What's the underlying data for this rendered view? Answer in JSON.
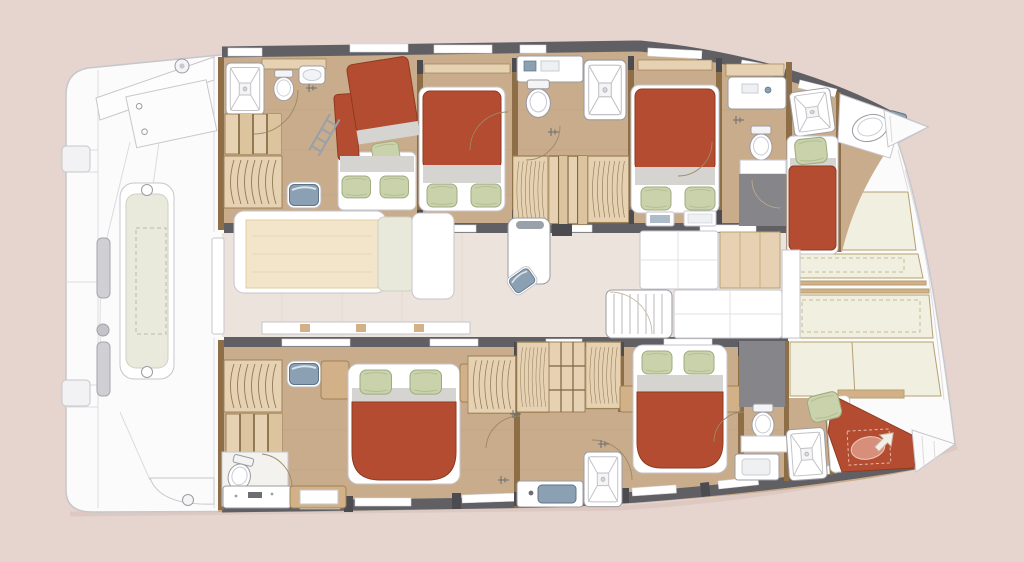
{
  "meta": {
    "title": "Catamaran yacht interior floor plan",
    "view": "top-down deck plan, bow pointing right",
    "diagram_type": "boat-layout"
  },
  "palette": {
    "bg": "#e6d4ce",
    "hull": "#fbfbfc",
    "hullline": "#c7c7cb",
    "seam": "#dcdce0",
    "band": "#5f5f64",
    "banddk": "#4b4b50",
    "wall": "#8d6e46",
    "wood": "#c9ac8b",
    "wooddk": "#b5976f",
    "woodlt": "#e6d2b3",
    "woodmd": "#d3b188",
    "red": "#b44c31",
    "reddk": "#8f3a22",
    "sheet": "#d5d4d1",
    "pillow": "#c9d2ab",
    "pillowdk": "#9fac7f",
    "fixline": "#9b9ba1",
    "fixlinelt": "#c6c6cc",
    "steel": "#8ba0b2",
    "steeldk": "#5f7386",
    "salon": "#ece3dd",
    "salonline": "#ddd0c7",
    "table": "#f3e5ca",
    "tabledk": "#e2cda4",
    "cream": "#f0efe0",
    "creamline": "#b4a071",
    "grayfloor": "#85858a",
    "bench": "#e9eadb",
    "shadow": "#d8c3bc"
  },
  "inventory": {
    "red_mattresses": 7,
    "green_pillows": 13,
    "showers": 5,
    "toilets": 5,
    "washbasins": 9,
    "wardrobes": 7,
    "staircases": 4,
    "dining_tables": 1,
    "galley_islands": 1
  },
  "rooms": [
    {
      "id": "aft-cockpit",
      "features": [
        "bench-seat",
        "swim-platform",
        "crossbeam",
        "access-steps"
      ]
    },
    {
      "id": "salon",
      "features": [
        "dining-table",
        "l-sofa",
        "chaise",
        "galley-island",
        "galley-counter",
        "companionway-stairs"
      ]
    },
    {
      "id": "upper-aft-cabin",
      "features": [
        "bunk-bed",
        "ladder",
        "shower",
        "toilet",
        "washbasin",
        "vanity-sink",
        "wardrobe",
        "stairs"
      ]
    },
    {
      "id": "upper-mid-cabin",
      "features": [
        "double-bed"
      ]
    },
    {
      "id": "upper-bathroom",
      "features": [
        "toilet",
        "washbasin",
        "shower",
        "wardrobes",
        "stairs"
      ]
    },
    {
      "id": "upper-fwd-cabin",
      "features": [
        "double-bed"
      ]
    },
    {
      "id": "upper-fwd-bathroom",
      "features": [
        "washbasin",
        "toilet",
        "shower"
      ]
    },
    {
      "id": "upper-bow-berth",
      "features": [
        "single-berth",
        "washbasin"
      ]
    },
    {
      "id": "lower-aft-cabin",
      "features": [
        "double-bed",
        "wardrobes",
        "stairs",
        "vanity-sink",
        "toilet",
        "washbasin"
      ]
    },
    {
      "id": "lower-mid-storage",
      "features": [
        "wardrobes",
        "shelves",
        "washbasin",
        "shower"
      ]
    },
    {
      "id": "lower-fwd-cabin",
      "features": [
        "double-bed",
        "nightstands"
      ]
    },
    {
      "id": "lower-fwd-bathroom",
      "features": [
        "toilet",
        "washbasin",
        "shower"
      ]
    },
    {
      "id": "lower-bow-berth",
      "features": [
        "single-berth",
        "hatch-arrow"
      ]
    },
    {
      "id": "foredeck",
      "features": [
        "storage-lockers",
        "crossbeam"
      ]
    }
  ]
}
